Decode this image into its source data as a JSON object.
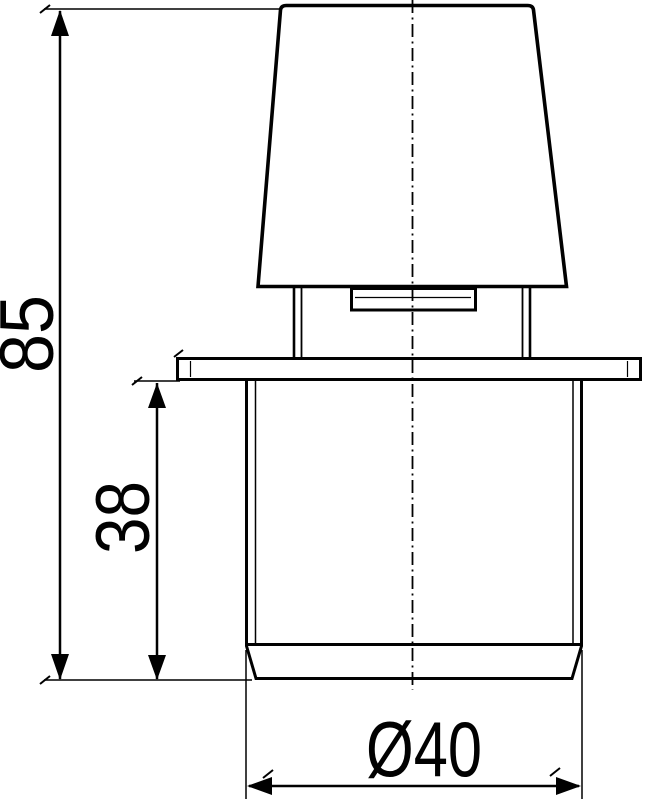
{
  "drawing": {
    "background_color": "#ffffff",
    "line_color": "#000000",
    "dimensions": {
      "overall_height": {
        "label": "85"
      },
      "insert_depth": {
        "label": "38"
      },
      "diameter": {
        "label": "Ø40"
      }
    }
  }
}
